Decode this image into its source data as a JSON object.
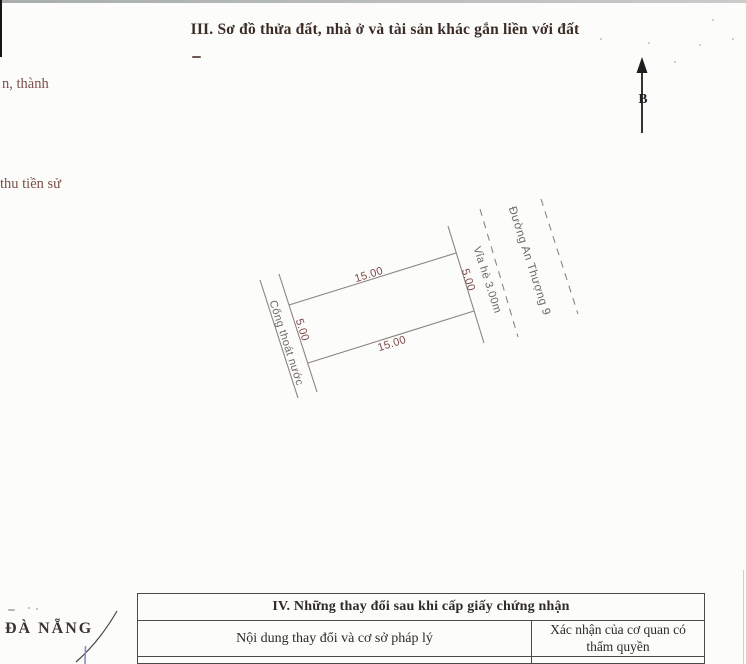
{
  "header": {
    "section3_title": "III. Sơ đồ thửa đất, nhà ở và tài sản khác gắn liền với đất"
  },
  "margin_notes": {
    "note1": "n, thành",
    "note2": "thu tiền sử",
    "city": "ĐÀ NẴNG"
  },
  "compass": {
    "north_label": "B"
  },
  "plot": {
    "top_dim": "15.00",
    "bottom_dim": "15.00",
    "left_dim": "5.00",
    "right_dim": "5.00",
    "drain_label": "Cống thoát nước",
    "sidewalk_label": "Vỉa hè 3.00m",
    "street_label": "Đường An Thượng 9"
  },
  "changes_table": {
    "title": "IV. Những thay đổi sau khi cấp giấy chứng nhận",
    "columns": [
      "Nội dung thay đổi và cơ sở pháp lý",
      "Xác nhận của cơ quan có thẩm quyền"
    ]
  },
  "colors": {
    "dimension_text": "#7d4a4a",
    "road_text": "#6e6963",
    "margin_text": "#7c4f48",
    "heading_text": "#3b2d26",
    "diagram_line": "#8d857c",
    "table_border": "#4a4a4a",
    "blue_mark": "#8691c2"
  }
}
